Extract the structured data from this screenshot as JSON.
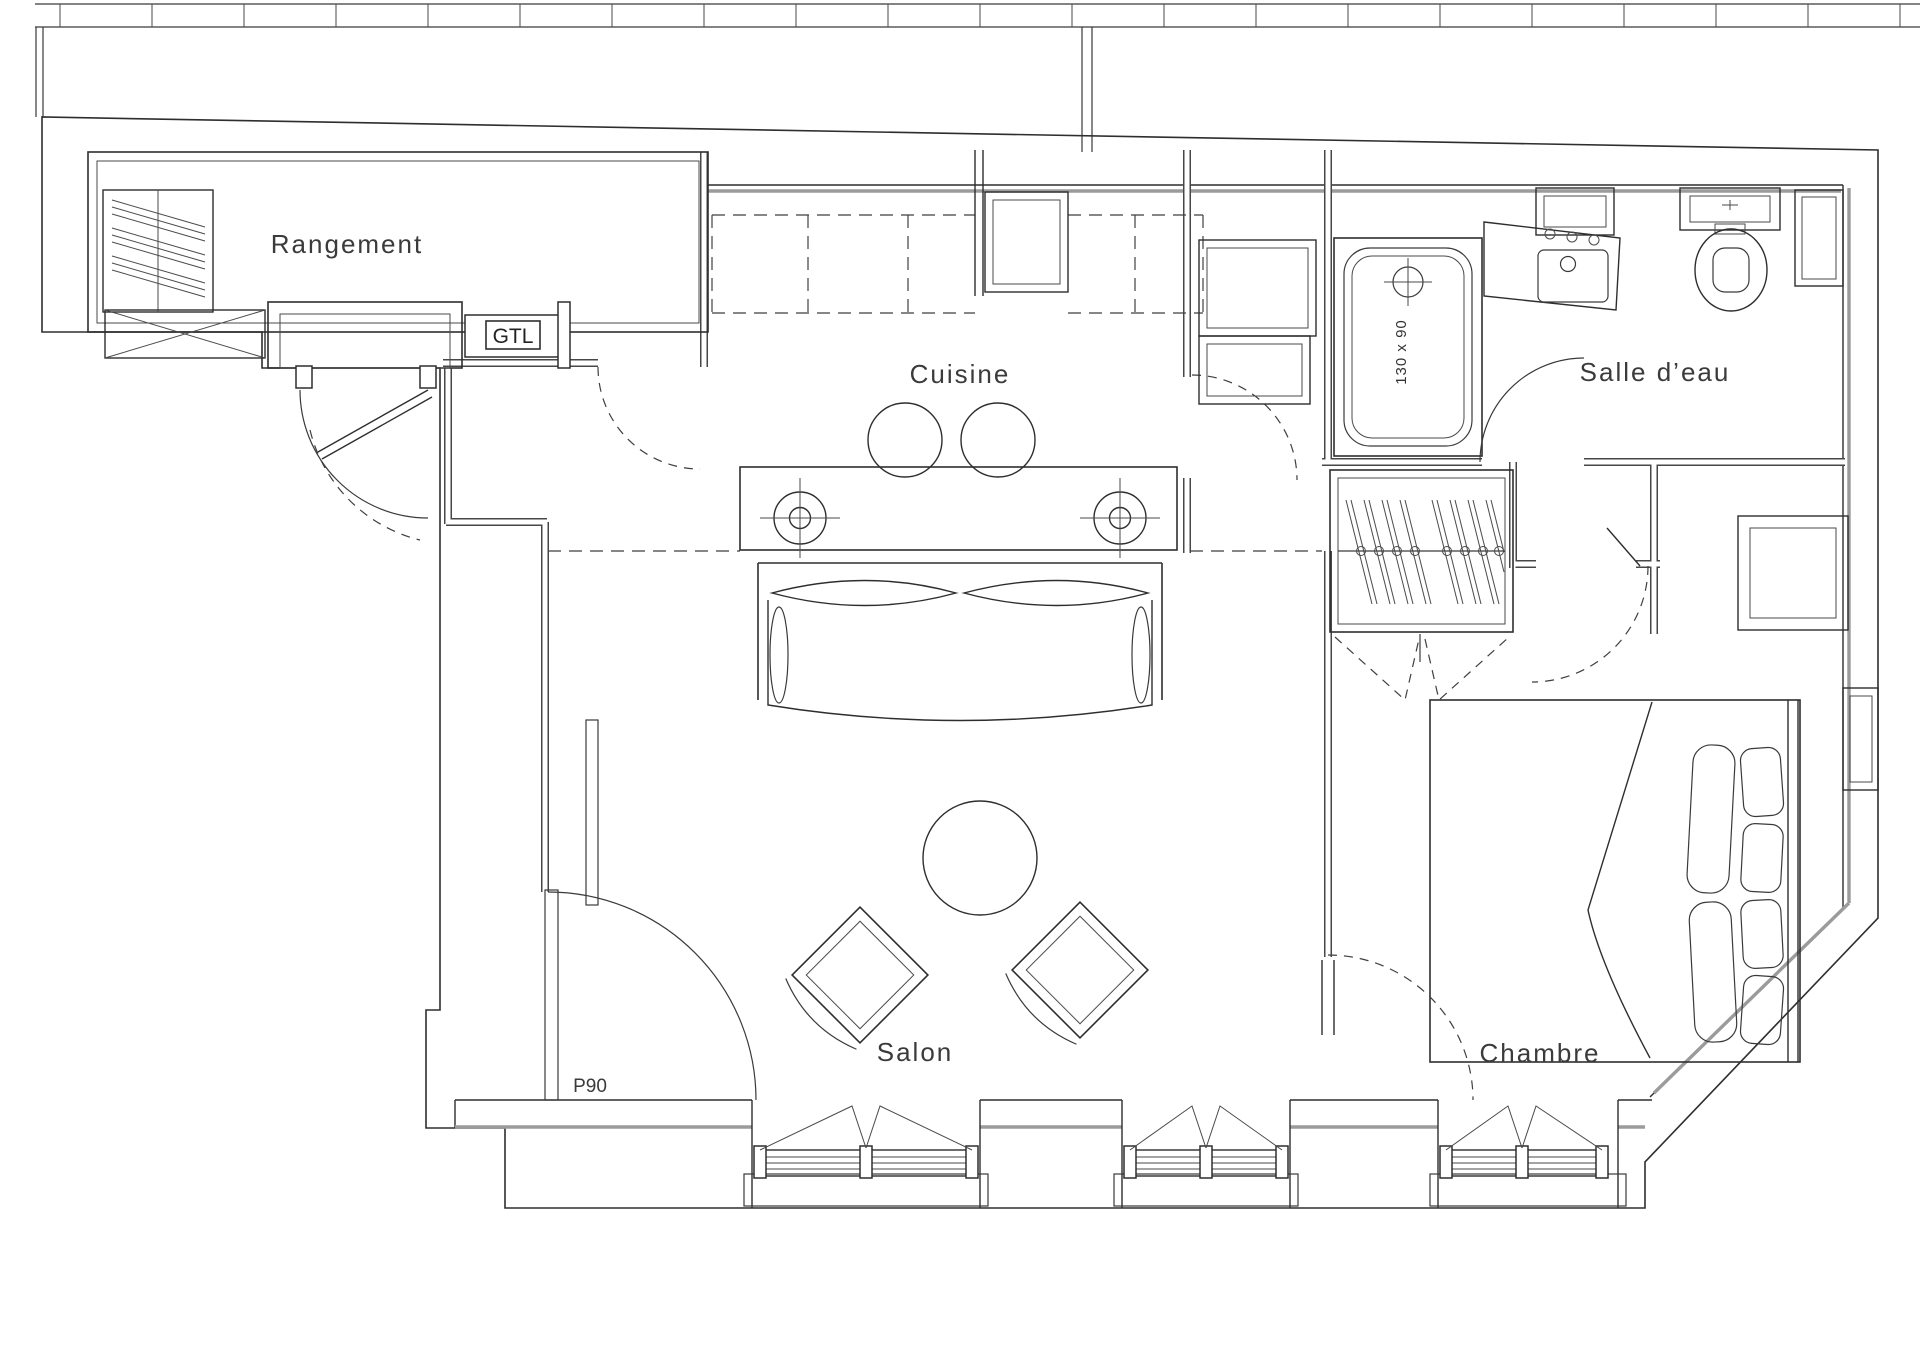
{
  "document": {
    "type": "architectural-floor-plan",
    "style": "black and white CAD linework on white sheet",
    "line_color": "#2e2e2e",
    "wall_accent_color": "#9b9b9b"
  },
  "labels": {
    "rangement": "Rangement",
    "cuisine": "Cuisine",
    "salle_deau": "Salle d’eau",
    "salon": "Salon",
    "chambre": "Chambre"
  },
  "annotations": {
    "gtl": "GTL",
    "door_code": "P90",
    "bathtub_size": "130 x 90"
  },
  "fixtures": [
    "storage-shelves",
    "reserved-cross-area",
    "entry-door",
    "gtl-electrical-box",
    "overhead-cabinets-dashed",
    "refrigerator-unit",
    "kitchen-island",
    "bar-stools",
    "hob-crosshairs",
    "sofa",
    "coffee-table",
    "armchairs",
    "wall-radiator",
    "bathtub",
    "washbasin-vanity",
    "toilet",
    "bathroom-window",
    "corner-cabinet",
    "appliance-column",
    "wardrobe-hangers",
    "bifold-doors",
    "double-bed",
    "pillows",
    "headboard",
    "window-alcove",
    "french-windows",
    "door-swings"
  ]
}
